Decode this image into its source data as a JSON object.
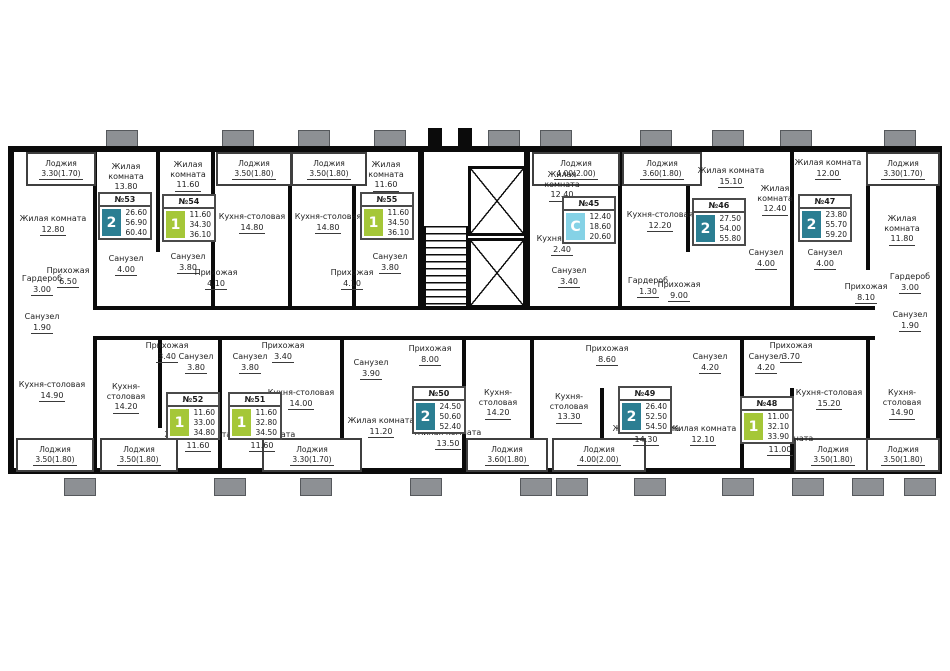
{
  "colors": {
    "wall": "#0b0b0b",
    "background": "#ffffff",
    "badge_one_room": "#a5c738",
    "badge_two_room": "#2b7e92",
    "badge_studio": "#85d2e6",
    "balcony_divider": "#8d9094"
  },
  "apartments": [
    {
      "num": "№53",
      "type": "2",
      "a1": "26.60",
      "a2": "56.90",
      "a3": "60.40"
    },
    {
      "num": "№54",
      "type": "1",
      "a1": "11.60",
      "a2": "34.30",
      "a3": "36.10"
    },
    {
      "num": "№55",
      "type": "1",
      "a1": "11.60",
      "a2": "34.50",
      "a3": "36.10"
    },
    {
      "num": "№45",
      "type": "С",
      "a1": "12.40",
      "a2": "18.60",
      "a3": "20.60"
    },
    {
      "num": "№46",
      "type": "2",
      "a1": "27.50",
      "a2": "54.00",
      "a3": "55.80"
    },
    {
      "num": "№47",
      "type": "2",
      "a1": "23.80",
      "a2": "55.70",
      "a3": "59.20"
    },
    {
      "num": "№52",
      "type": "1",
      "a1": "11.60",
      "a2": "33.00",
      "a3": "34.80"
    },
    {
      "num": "№51",
      "type": "1",
      "a1": "11.60",
      "a2": "32.80",
      "a3": "34.50"
    },
    {
      "num": "№50",
      "type": "2",
      "a1": "24.50",
      "a2": "50.60",
      "a3": "52.40"
    },
    {
      "num": "№49",
      "type": "2",
      "a1": "26.40",
      "a2": "52.50",
      "a3": "54.50"
    },
    {
      "num": "№48",
      "type": "1",
      "a1": "11.00",
      "a2": "32.10",
      "a3": "33.90"
    }
  ],
  "rooms": [
    {
      "n": "Лоджия",
      "a": "3.30(1.70)"
    },
    {
      "n": "Жилая комната",
      "a": "12.80"
    },
    {
      "n": "Гардероб",
      "a": "3.00"
    },
    {
      "n": "Санузел",
      "a": "1.90"
    },
    {
      "n": "Жилая комната",
      "a": "13.80"
    },
    {
      "n": "Санузел",
      "a": "4.00"
    },
    {
      "n": "Прихожая",
      "a": "6.50"
    },
    {
      "n": "Жилая комната",
      "a": "11.60"
    },
    {
      "n": "Санузел",
      "a": "3.80"
    },
    {
      "n": "Прихожая",
      "a": "4.10"
    },
    {
      "n": "Лоджия",
      "a": "3.50(1.80)"
    },
    {
      "n": "Кухня-столовая",
      "a": "14.80"
    },
    {
      "n": "Лоджия",
      "a": "3.50(1.80)"
    },
    {
      "n": "Кухня-столовая",
      "a": "14.80"
    },
    {
      "n": "Прихожая",
      "a": "4.10"
    },
    {
      "n": "Жилая комната",
      "a": "11.60"
    },
    {
      "n": "Санузел",
      "a": "3.80"
    },
    {
      "n": "Лоджия",
      "a": "4.00(2.00)"
    },
    {
      "n": "Жилая комната",
      "a": "12.40"
    },
    {
      "n": "Кухня-ниша",
      "a": "2.40"
    },
    {
      "n": "Санузел",
      "a": "3.40"
    },
    {
      "n": "Лоджия",
      "a": "3.60(1.80)"
    },
    {
      "n": "Кухня-столовая",
      "a": "12.20"
    },
    {
      "n": "Жилая комната",
      "a": "15.10"
    },
    {
      "n": "Жилая комната",
      "a": "12.40"
    },
    {
      "n": "Прихожая",
      "a": "9.00"
    },
    {
      "n": "Гардероб",
      "a": "1.30"
    },
    {
      "n": "Санузел",
      "a": "4.00"
    },
    {
      "n": "Санузел",
      "a": "4.00"
    },
    {
      "n": "Жилая комната",
      "a": "12.00"
    },
    {
      "n": "Лоджия",
      "a": "3.30(1.70)"
    },
    {
      "n": "Жилая комната",
      "a": "11.80"
    },
    {
      "n": "Прихожая",
      "a": "8.10"
    },
    {
      "n": "Гардероб",
      "a": "3.00"
    },
    {
      "n": "Санузел",
      "a": "1.90"
    },
    {
      "n": "Кухня-столовая",
      "a": "14.90"
    },
    {
      "n": "Лоджия",
      "a": "3.50(1.80)"
    },
    {
      "n": "Кухня-столовая",
      "a": "14.20"
    },
    {
      "n": "Прихожая",
      "a": "3.40"
    },
    {
      "n": "Санузел",
      "a": "3.80"
    },
    {
      "n": "Жилая комната",
      "a": "11.60"
    },
    {
      "n": "Лоджия",
      "a": "3.50(1.80)"
    },
    {
      "n": "Прихожая",
      "a": "3.40"
    },
    {
      "n": "Санузел",
      "a": "3.80"
    },
    {
      "n": "Жилая комната",
      "a": "11.60"
    },
    {
      "n": "Кухня-столовая",
      "a": "14.00"
    },
    {
      "n": "Лоджия",
      "a": "3.30(1.70)"
    },
    {
      "n": "Санузел",
      "a": "3.90"
    },
    {
      "n": "Жилая комната",
      "a": "11.20"
    },
    {
      "n": "Прихожая",
      "a": "8.00"
    },
    {
      "n": "Жилая комната",
      "a": "13.50"
    },
    {
      "n": "Кухня-столовая",
      "a": "14.20"
    },
    {
      "n": "Лоджия",
      "a": "3.60(1.80)"
    },
    {
      "n": "Прихожая",
      "a": "8.60"
    },
    {
      "n": "Кухня-столовая",
      "a": "13.30"
    },
    {
      "n": "Лоджия",
      "a": "4.00(2.00)"
    },
    {
      "n": "Жилая комната",
      "a": "14.30"
    },
    {
      "n": "Жилая комната",
      "a": "12.10"
    },
    {
      "n": "Санузел",
      "a": "4.20"
    },
    {
      "n": "Санузел",
      "a": "4.20"
    },
    {
      "n": "Прихожая",
      "a": "3.70"
    },
    {
      "n": "Жилая комната",
      "a": "11.00"
    },
    {
      "n": "Кухня-столовая",
      "a": "15.20"
    },
    {
      "n": "Лоджия",
      "a": "3.50(1.80)"
    },
    {
      "n": "Кухня-столовая",
      "a": "14.90"
    },
    {
      "n": "Лоджия",
      "a": "3.50(1.80)"
    }
  ]
}
